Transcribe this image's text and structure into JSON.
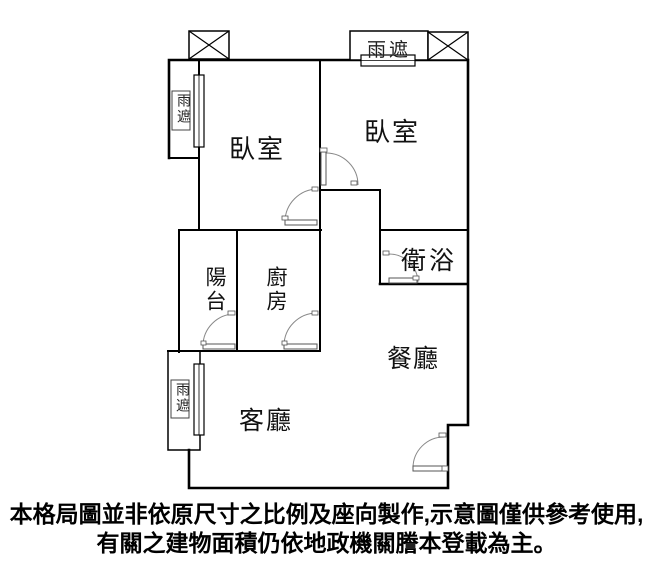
{
  "rooms": {
    "bedroom_left": "臥室",
    "bedroom_right": "臥室",
    "balcony": "陽台",
    "kitchen": "廚房",
    "bathroom": "衛浴",
    "dining_room": "餐廳",
    "living_room": "客廳"
  },
  "canopy": {
    "top": "雨遮",
    "upper_left": "雨遮",
    "lower_left": "雨遮"
  },
  "disclaimer": {
    "line1": "本格局圖並非依原尺寸之比例及座向製作,示意圖僅供參考使用,",
    "line2": "有關之建物面積仍依地政機關謄本登載為主。"
  },
  "colors": {
    "wall": "#000000",
    "background": "#ffffff",
    "door": "#777777",
    "text": "#111111"
  }
}
